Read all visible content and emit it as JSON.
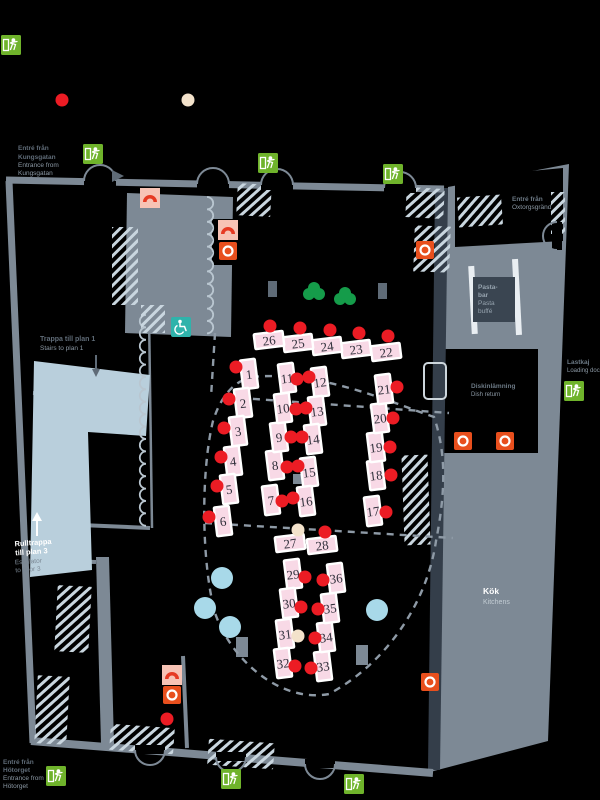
{
  "map": {
    "title": "Restaurant hall floor plan",
    "colors": {
      "background": "#000000",
      "wall": "#7d8995",
      "dark": "#343e4a",
      "light_blue": "#b9cfdc",
      "hatch": "#c9d6df",
      "table_fill": "#f8d9e6",
      "table_border": "#ffffff",
      "number": "#2f2f3a",
      "red_dot": "#ec1c24",
      "cream_dot": "#f3e2cb",
      "blue_circle": "#a8d9e9",
      "tree_green": "#159c4a",
      "exit_green": "#6fb32b",
      "extinguisher_orange": "#e84f1d",
      "hose_pink": "#f7c3b5",
      "hose_red": "#e63a23",
      "accessible_teal": "#2fb3ab",
      "dashed": "#8e9aa6",
      "label": "#5f6b77",
      "label_light": "#8b98a4"
    },
    "labels": {
      "entrance_top_left": [
        "Entré från",
        "Kungsgatan",
        "Entrance from",
        "Kungsgatan"
      ],
      "entrance_bottom_left": [
        "Entré från",
        "Hötorget",
        "Entrance from",
        "Hötorget"
      ],
      "entrance_top_right": [
        "Entré från",
        "Oxtorgsgränd"
      ],
      "stairs_sv": "Trappa till plan 1",
      "stairs_en": "Stairs to plan 1",
      "escalator_sv1": "Rulltrappa",
      "escalator_sv2": "till plan 3",
      "escalator_en1": "Escalator",
      "escalator_en2": "to floor 3",
      "loading_sv": "Lastkaj",
      "loading_en": "Loading dock",
      "dish_sv": "Diskinlämning",
      "dish_en": "Dish return",
      "pasta_lines": [
        "Pasta-",
        "bar",
        "Pasta",
        "buffé"
      ],
      "kitchen_sv": "Kök",
      "kitchen_en": "Kitchens"
    },
    "tables": [
      {
        "n": 1,
        "x": 249,
        "y": 374,
        "o": "v"
      },
      {
        "n": 2,
        "x": 243,
        "y": 403,
        "o": "v"
      },
      {
        "n": 3,
        "x": 238,
        "y": 431,
        "o": "v"
      },
      {
        "n": 4,
        "x": 233,
        "y": 461,
        "o": "v"
      },
      {
        "n": 5,
        "x": 229,
        "y": 489,
        "o": "v"
      },
      {
        "n": 6,
        "x": 223,
        "y": 521,
        "o": "v"
      },
      {
        "n": 7,
        "x": 271,
        "y": 500,
        "o": "v"
      },
      {
        "n": 8,
        "x": 275,
        "y": 465,
        "o": "v"
      },
      {
        "n": 9,
        "x": 279,
        "y": 437,
        "o": "v"
      },
      {
        "n": 10,
        "x": 283,
        "y": 408,
        "o": "v"
      },
      {
        "n": 11,
        "x": 287,
        "y": 378,
        "o": "v"
      },
      {
        "n": 12,
        "x": 320,
        "y": 382,
        "o": "v"
      },
      {
        "n": 13,
        "x": 317,
        "y": 411,
        "o": "v"
      },
      {
        "n": 14,
        "x": 313,
        "y": 439,
        "o": "v"
      },
      {
        "n": 15,
        "x": 309,
        "y": 472,
        "o": "v"
      },
      {
        "n": 16,
        "x": 306,
        "y": 501,
        "o": "v"
      },
      {
        "n": 17,
        "x": 373,
        "y": 511,
        "o": "v"
      },
      {
        "n": 18,
        "x": 376,
        "y": 475,
        "o": "v"
      },
      {
        "n": 19,
        "x": 376,
        "y": 447,
        "o": "v"
      },
      {
        "n": 20,
        "x": 380,
        "y": 418,
        "o": "v"
      },
      {
        "n": 21,
        "x": 384,
        "y": 389,
        "o": "v"
      },
      {
        "n": 22,
        "x": 386,
        "y": 352,
        "o": "h"
      },
      {
        "n": 23,
        "x": 356,
        "y": 349,
        "o": "h"
      },
      {
        "n": 24,
        "x": 327,
        "y": 346,
        "o": "h"
      },
      {
        "n": 25,
        "x": 298,
        "y": 343,
        "o": "h"
      },
      {
        "n": 26,
        "x": 269,
        "y": 340,
        "o": "h"
      },
      {
        "n": 27,
        "x": 290,
        "y": 543,
        "o": "h"
      },
      {
        "n": 28,
        "x": 322,
        "y": 545,
        "o": "h"
      },
      {
        "n": 29,
        "x": 293,
        "y": 574,
        "o": "v"
      },
      {
        "n": 30,
        "x": 289,
        "y": 603,
        "o": "v"
      },
      {
        "n": 31,
        "x": 285,
        "y": 634,
        "o": "v"
      },
      {
        "n": 32,
        "x": 283,
        "y": 663,
        "o": "v"
      },
      {
        "n": 33,
        "x": 323,
        "y": 666,
        "o": "v"
      },
      {
        "n": 34,
        "x": 326,
        "y": 637,
        "o": "v"
      },
      {
        "n": 35,
        "x": 330,
        "y": 608,
        "o": "v"
      },
      {
        "n": 36,
        "x": 336,
        "y": 578,
        "o": "v"
      }
    ],
    "dots": {
      "red": [
        [
          62,
          100
        ],
        [
          167,
          719
        ],
        [
          270,
          326
        ],
        [
          300,
          328
        ],
        [
          330,
          330
        ],
        [
          359,
          333
        ],
        [
          388,
          336
        ],
        [
          236,
          367
        ],
        [
          229,
          399
        ],
        [
          224,
          428
        ],
        [
          221,
          457
        ],
        [
          217,
          486
        ],
        [
          209,
          517
        ],
        [
          297,
          379
        ],
        [
          309,
          377
        ],
        [
          296,
          409
        ],
        [
          306,
          408
        ],
        [
          291,
          437
        ],
        [
          302,
          437
        ],
        [
          287,
          467
        ],
        [
          298,
          466
        ],
        [
          282,
          501
        ],
        [
          293,
          498
        ],
        [
          397,
          387
        ],
        [
          393,
          418
        ],
        [
          390,
          447
        ],
        [
          391,
          475
        ],
        [
          386,
          512
        ],
        [
          325,
          532
        ],
        [
          305,
          577
        ],
        [
          323,
          580
        ],
        [
          301,
          607
        ],
        [
          318,
          609
        ],
        [
          315,
          638
        ],
        [
          295,
          666
        ],
        [
          311,
          668
        ]
      ],
      "cream": [
        [
          188,
          100
        ],
        [
          298,
          530
        ],
        [
          298,
          636
        ]
      ],
      "blue": [
        [
          222,
          578
        ],
        [
          205,
          608
        ],
        [
          230,
          627
        ],
        [
          377,
          610
        ]
      ]
    },
    "icons": {
      "exit": [
        [
          11,
          45
        ],
        [
          93,
          154
        ],
        [
          268,
          163
        ],
        [
          393,
          174
        ],
        [
          574,
          391
        ],
        [
          56,
          776
        ],
        [
          231,
          779
        ],
        [
          354,
          784
        ]
      ],
      "extinguisher": [
        [
          425,
          250
        ],
        [
          463,
          441
        ],
        [
          505,
          441
        ],
        [
          430,
          682
        ],
        [
          172,
          695
        ],
        [
          228,
          251
        ]
      ],
      "hose_reel": [
        [
          150,
          198
        ],
        [
          228,
          230
        ],
        [
          172,
          675
        ]
      ],
      "accessible": [
        [
          181,
          327
        ]
      ]
    },
    "trees": [
      [
        314,
        292
      ],
      [
        345,
        297
      ]
    ]
  }
}
